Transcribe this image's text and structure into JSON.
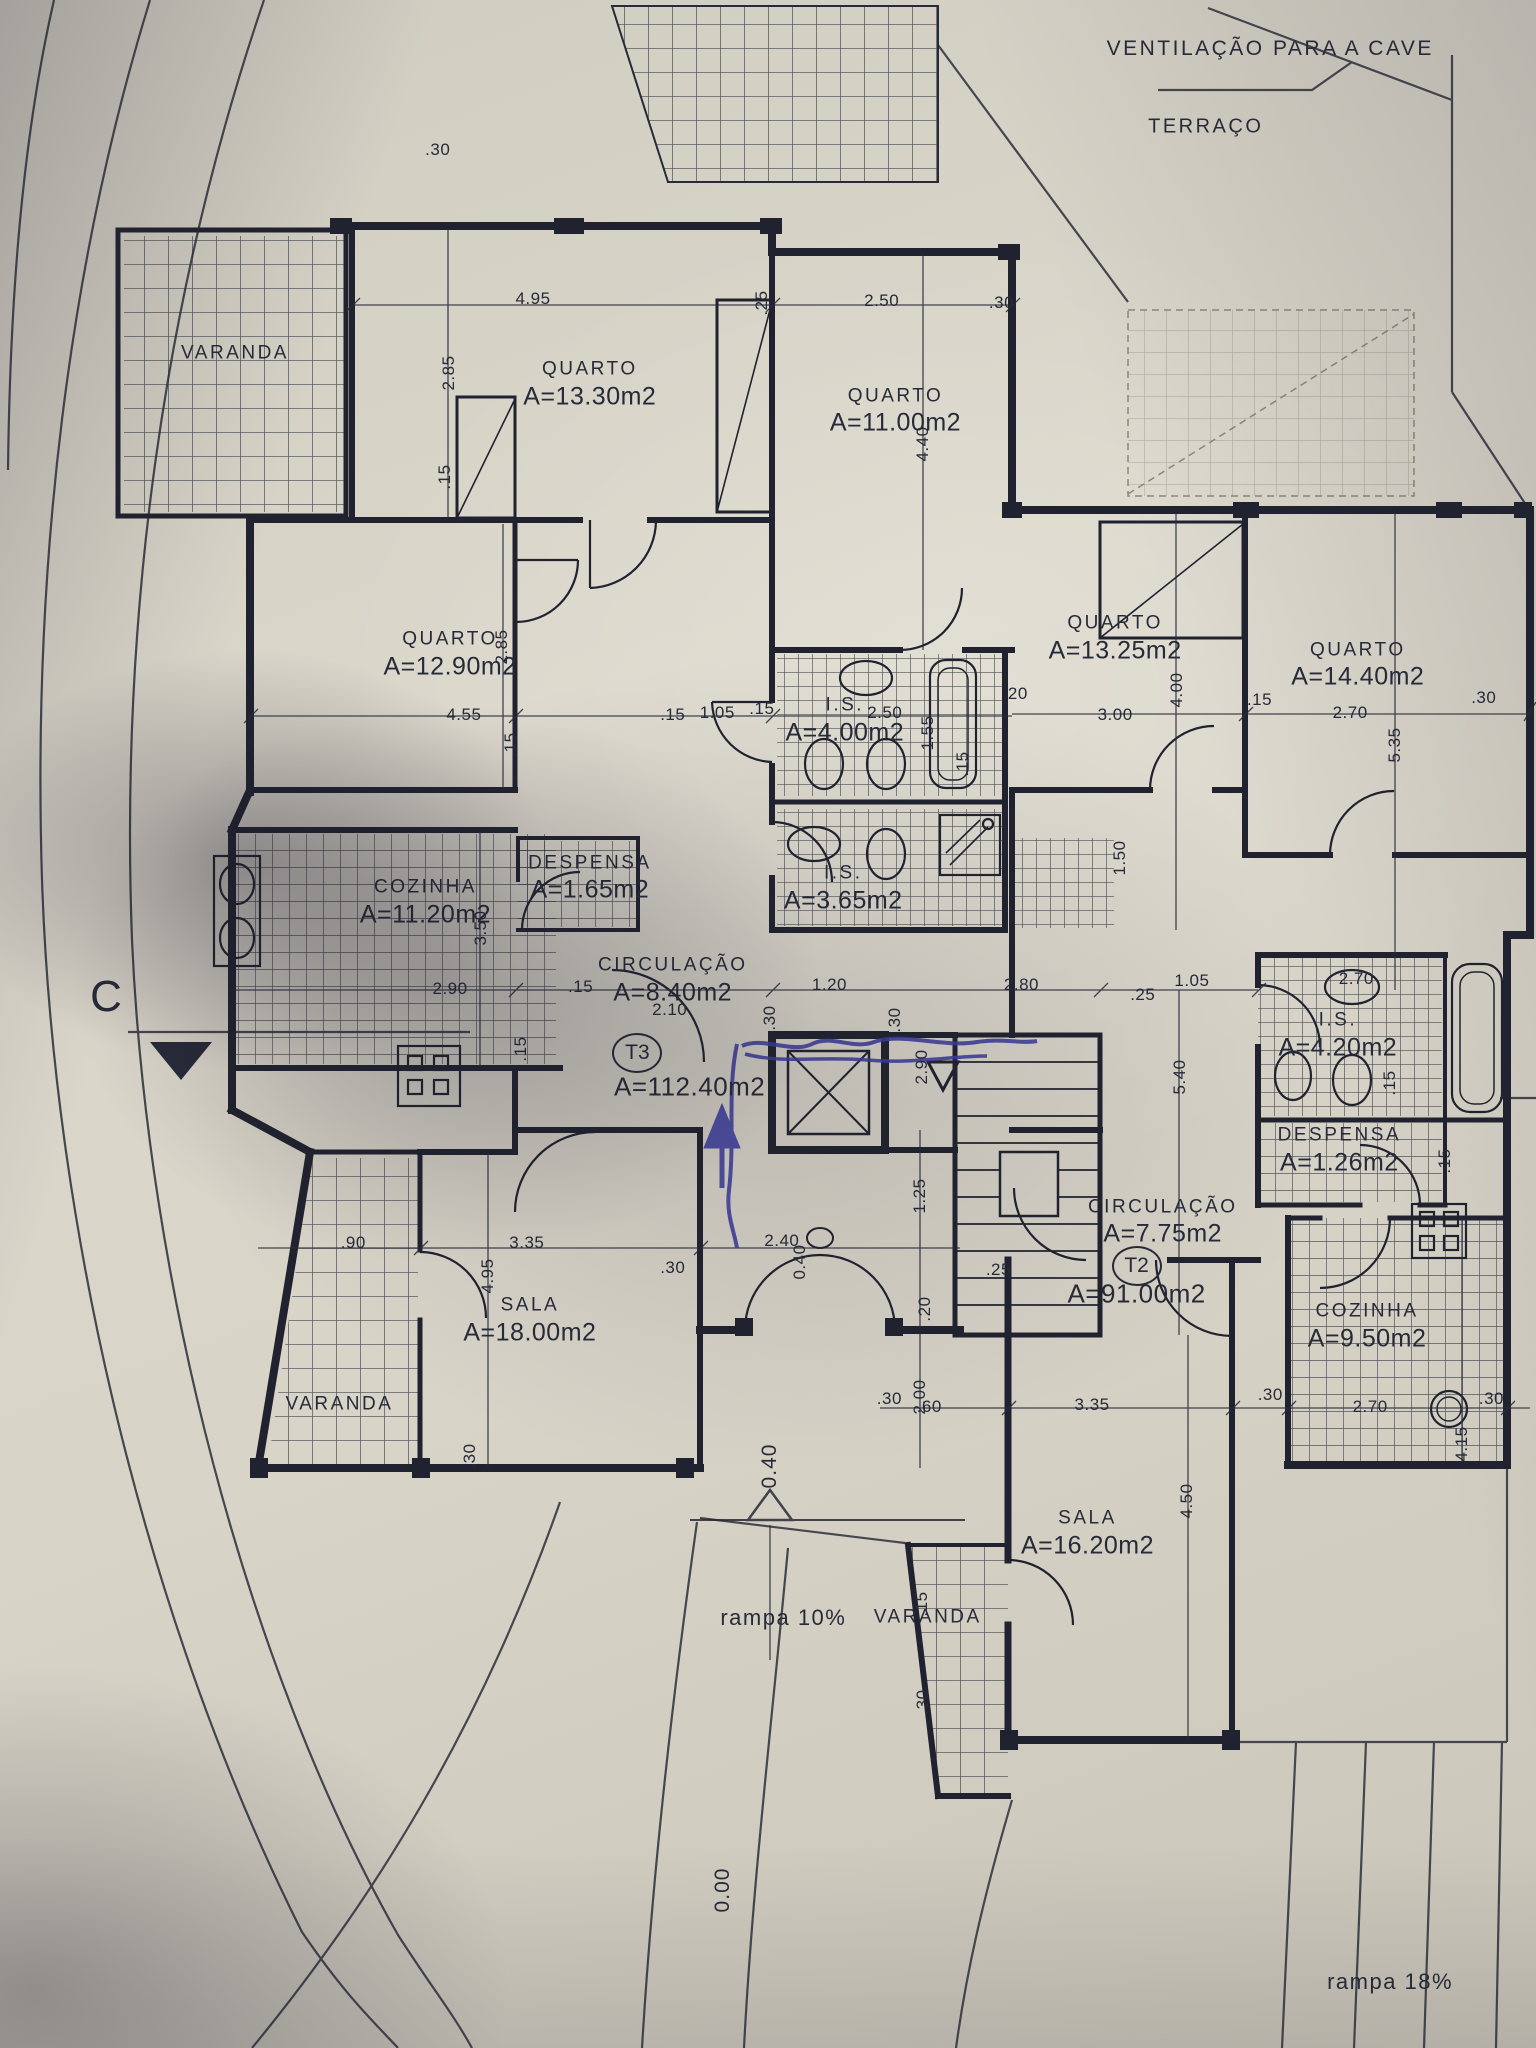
{
  "colors": {
    "paper": "#d8d4c9",
    "ink": "#272a38",
    "pen": "#3d3da0",
    "site": "#45464e",
    "pencil": "#8d8878"
  },
  "annotations": {
    "ventilation_note": "VENTILAÇÃO PARA A CAVE",
    "terrace_label": "TERRAÇO",
    "ramp_left": "rampa 10%",
    "ramp_right": "rampa 18%",
    "section_marker": "C"
  },
  "levels": [
    {
      "value": "0.40"
    },
    {
      "value": "0.00"
    }
  ],
  "units": [
    {
      "code": "T3",
      "total_area": "A=112.40m2"
    },
    {
      "code": "T2",
      "total_area": "A=91.00m2"
    }
  ],
  "rooms": [
    {
      "name": "VARANDA",
      "area": "",
      "x": 15.3,
      "y": 17.3
    },
    {
      "name": "QUARTO",
      "area": "A=13.30m2",
      "x": 38.4,
      "y": 18.8
    },
    {
      "name": "QUARTO",
      "area": "A=11.00m2",
      "x": 58.3,
      "y": 20.1
    },
    {
      "name": "QUARTO",
      "area": "A=12.90m2",
      "x": 29.3,
      "y": 32.0
    },
    {
      "name": "QUARTO",
      "area": "A=13.25m2",
      "x": 72.6,
      "y": 31.2
    },
    {
      "name": "QUARTO",
      "area": "A=14.40m2",
      "x": 88.4,
      "y": 32.5
    },
    {
      "name": "I.S.",
      "area": "A=4.00m2",
      "x": 55.0,
      "y": 35.2
    },
    {
      "name": "I.S.",
      "area": "A=3.65m2",
      "x": 54.9,
      "y": 43.4
    },
    {
      "name": "COZINHA",
      "area": "A=11.20m2",
      "x": 27.7,
      "y": 44.1
    },
    {
      "name": "DESPENSA",
      "area": "A=1.65m2",
      "x": 38.4,
      "y": 42.9
    },
    {
      "name": "CIRCULAÇÃO",
      "area": "A=8.40m2",
      "x": 43.8,
      "y": 47.9
    },
    {
      "name": "SALA",
      "area": "A=18.00m2",
      "x": 34.5,
      "y": 64.5
    },
    {
      "name": "VARANDA",
      "area": "",
      "x": 22.1,
      "y": 68.6
    },
    {
      "name": "I.S.",
      "area": "A=4.20m2",
      "x": 87.1,
      "y": 50.6
    },
    {
      "name": "DESPENSA",
      "area": "A=1.26m2",
      "x": 87.2,
      "y": 56.2
    },
    {
      "name": "CIRCULAÇÃO",
      "area": "A=7.75m2",
      "x": 75.7,
      "y": 59.7
    },
    {
      "name": "COZINHA",
      "area": "A=9.50m2",
      "x": 89.0,
      "y": 64.8
    },
    {
      "name": "SALA",
      "area": "A=16.20m2",
      "x": 70.8,
      "y": 74.9
    },
    {
      "name": "VARANDA",
      "area": "",
      "x": 60.4,
      "y": 79.0
    }
  ],
  "dimensions": [
    {
      "t": ".30",
      "x": 28.5,
      "y": 7.3
    },
    {
      "t": "4.95",
      "x": 34.7,
      "y": 14.6
    },
    {
      "t": ".25",
      "x": 49.6,
      "y": 14.8,
      "v": true
    },
    {
      "t": "2.50",
      "x": 57.4,
      "y": 14.7
    },
    {
      "t": ".30",
      "x": 65.2,
      "y": 14.8
    },
    {
      "t": "2.85",
      "x": 29.2,
      "y": 18.2,
      "v": true
    },
    {
      "t": ".15",
      "x": 29.0,
      "y": 23.3,
      "v": true
    },
    {
      "t": "4.40",
      "x": 60.1,
      "y": 21.7,
      "v": true
    },
    {
      "t": "2.85",
      "x": 32.7,
      "y": 31.6,
      "v": true
    },
    {
      "t": "4.55",
      "x": 30.2,
      "y": 34.9
    },
    {
      "t": ".15",
      "x": 33.3,
      "y": 36.4,
      "v": true
    },
    {
      "t": ".15",
      "x": 43.8,
      "y": 34.9
    },
    {
      "t": "1.05",
      "x": 46.7,
      "y": 34.8
    },
    {
      "t": "2.50",
      "x": 57.6,
      "y": 34.8
    },
    {
      "t": "1.55",
      "x": 60.4,
      "y": 35.8,
      "v": true
    },
    {
      "t": ".15",
      "x": 49.6,
      "y": 34.6
    },
    {
      "t": ".20",
      "x": 66.1,
      "y": 33.9
    },
    {
      "t": "3.00",
      "x": 72.6,
      "y": 34.9
    },
    {
      "t": "4.00",
      "x": 76.6,
      "y": 33.7,
      "v": true
    },
    {
      "t": ".15",
      "x": 82.0,
      "y": 34.2
    },
    {
      "t": "2.70",
      "x": 87.9,
      "y": 34.8
    },
    {
      "t": "5.35",
      "x": 90.8,
      "y": 36.4,
      "v": true
    },
    {
      "t": ".30",
      "x": 96.6,
      "y": 34.1
    },
    {
      "t": ".15",
      "x": 62.7,
      "y": 37.3,
      "v": true
    },
    {
      "t": "1.50",
      "x": 72.9,
      "y": 41.9,
      "v": true
    },
    {
      "t": "2.90",
      "x": 29.3,
      "y": 48.3
    },
    {
      "t": "3.50",
      "x": 31.3,
      "y": 45.3,
      "v": true
    },
    {
      "t": ".15",
      "x": 37.8,
      "y": 48.2
    },
    {
      "t": ".15",
      "x": 33.9,
      "y": 51.2,
      "v": true
    },
    {
      "t": "1.20",
      "x": 54.0,
      "y": 48.1
    },
    {
      "t": ".30",
      "x": 50.1,
      "y": 49.7,
      "v": true
    },
    {
      "t": ".30",
      "x": 58.3,
      "y": 49.8,
      "v": true
    },
    {
      "t": "2.80",
      "x": 66.5,
      "y": 48.1
    },
    {
      "t": ".25",
      "x": 74.4,
      "y": 48.6
    },
    {
      "t": "1.05",
      "x": 77.6,
      "y": 47.9
    },
    {
      "t": "2.90",
      "x": 60.0,
      "y": 52.1,
      "v": true
    },
    {
      "t": "5.40",
      "x": 76.8,
      "y": 52.6,
      "v": true
    },
    {
      "t": "2.70",
      "x": 88.3,
      "y": 47.8
    },
    {
      "t": ".15",
      "x": 90.5,
      "y": 52.9,
      "v": true
    },
    {
      "t": ".15",
      "x": 94.1,
      "y": 56.7,
      "v": true
    },
    {
      "t": "2.10",
      "x": 43.6,
      "y": 49.3
    },
    {
      "t": ".90",
      "x": 23.0,
      "y": 60.7
    },
    {
      "t": "3.35",
      "x": 34.3,
      "y": 60.7
    },
    {
      "t": "4.95",
      "x": 31.8,
      "y": 62.3,
      "v": true
    },
    {
      "t": ".30",
      "x": 43.8,
      "y": 61.9
    },
    {
      "t": "2.40",
      "x": 50.9,
      "y": 60.6
    },
    {
      "t": "0.40",
      "x": 52.1,
      "y": 61.6,
      "v": true
    },
    {
      "t": "1.25",
      "x": 59.9,
      "y": 58.4,
      "v": true
    },
    {
      "t": ".25",
      "x": 65.0,
      "y": 62.0
    },
    {
      "t": ".20",
      "x": 60.2,
      "y": 63.9,
      "v": true
    },
    {
      "t": ".30",
      "x": 57.9,
      "y": 68.3
    },
    {
      "t": "2.00",
      "x": 59.9,
      "y": 68.2,
      "v": true
    },
    {
      "t": ".60",
      "x": 60.5,
      "y": 68.7
    },
    {
      "t": "3.35",
      "x": 71.1,
      "y": 68.6
    },
    {
      "t": "4.50",
      "x": 77.3,
      "y": 73.3,
      "v": true
    },
    {
      "t": ".30",
      "x": 82.7,
      "y": 68.1
    },
    {
      "t": "2.70",
      "x": 89.2,
      "y": 68.7
    },
    {
      "t": ".30",
      "x": 97.1,
      "y": 68.3
    },
    {
      "t": "4.15",
      "x": 95.2,
      "y": 70.5,
      "v": true
    },
    {
      "t": ".30",
      "x": 30.6,
      "y": 71.1,
      "v": true
    },
    {
      "t": ".15",
      "x": 60.0,
      "y": 78.3,
      "v": true
    },
    {
      "t": ".30",
      "x": 60.1,
      "y": 83.1,
      "v": true
    }
  ]
}
